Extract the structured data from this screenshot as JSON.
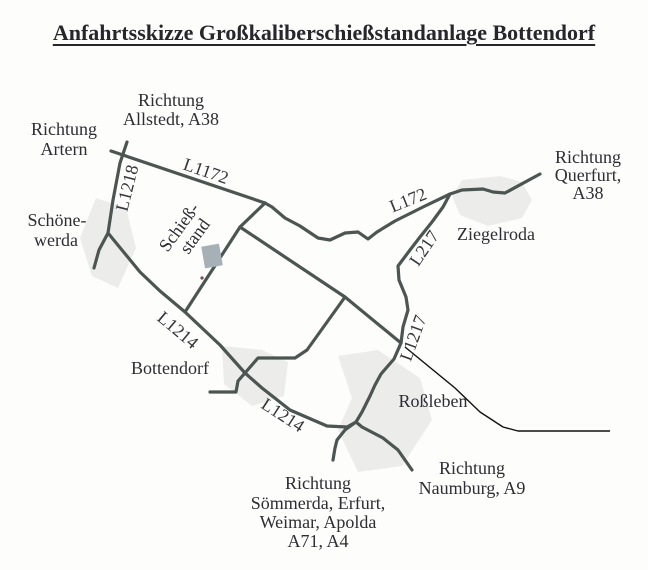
{
  "title": "Anfahrtsskizze Großkaliberschießstandanlage Bottendorf",
  "map": {
    "colors": {
      "road": "#4b5551",
      "pointer": "#111111",
      "text": "#2d2d33",
      "site_marker": "#a6b0b7",
      "settlement": "#ecedeb",
      "background": "#fdfdfc"
    },
    "road_labels": [
      {
        "text": "L1172"
      },
      {
        "text": "L1218"
      },
      {
        "text": "L172"
      },
      {
        "text": "L217"
      },
      {
        "text": "L1217"
      },
      {
        "text": "L1214"
      },
      {
        "text": "L1214"
      }
    ],
    "place_labels": [
      {
        "id": "schoenewerda",
        "lines": [
          "Schöne-",
          "werda"
        ]
      },
      {
        "id": "ziegelroda",
        "lines": [
          "Ziegelroda"
        ]
      },
      {
        "id": "bottendorf",
        "lines": [
          "Bottendorf"
        ]
      },
      {
        "id": "rossleben",
        "lines": [
          "Roßleben"
        ]
      }
    ],
    "direction_labels": [
      {
        "id": "artern",
        "lines": [
          "Richtung",
          "Artern"
        ]
      },
      {
        "id": "allstedt",
        "lines": [
          "Richtung",
          "Allstedt, A38"
        ]
      },
      {
        "id": "querfurt",
        "lines": [
          "Richtung",
          "Querfurt,",
          "A38"
        ]
      },
      {
        "id": "naumburg",
        "lines": [
          "Richtung",
          "Naumburg, A9"
        ]
      },
      {
        "id": "soemmerda",
        "lines": [
          "Richtung",
          "Sömmerda, Erfurt,",
          "Weimar, Apolda",
          "A71, A4"
        ]
      }
    ],
    "site_label": {
      "lines": [
        "Schieß-",
        "stand"
      ]
    }
  }
}
